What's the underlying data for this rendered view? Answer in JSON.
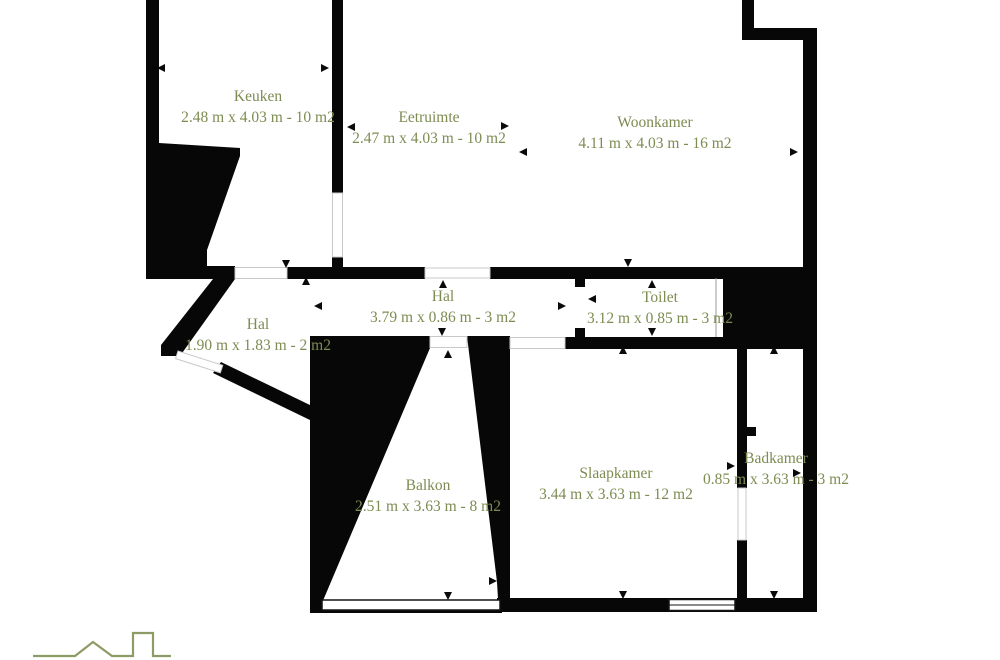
{
  "colors": {
    "label-green": "#7d8c52",
    "logo-green": "#8d9c66",
    "wall-black": "#070707"
  },
  "rooms": [
    {
      "name": "Keuken",
      "dims": "2.48 m x 4.03 m - 10 m2"
    },
    {
      "name": "Eetruimte",
      "dims": "2.47 m x 4.03 m - 10 m2"
    },
    {
      "name": "Woonkamer",
      "dims": "4.11 m x 4.03 m - 16 m2"
    },
    {
      "name": "Hal",
      "dims": "3.79 m x 0.86 m - 3 m2"
    },
    {
      "name": "Hal",
      "dims": "1.90 m x 1.83 m - 2 m2"
    },
    {
      "name": "Toilet",
      "dims": "3.12 m x 0.85 m - 3 m2"
    },
    {
      "name": "Balkon",
      "dims": "2.51 m x 3.63 m - 8 m2"
    },
    {
      "name": "Slaapkamer",
      "dims": "3.44 m x 3.63 m - 12 m2"
    },
    {
      "name": "Badkamer",
      "dims": "0.85 m x 3.63 m - 3 m2"
    }
  ]
}
